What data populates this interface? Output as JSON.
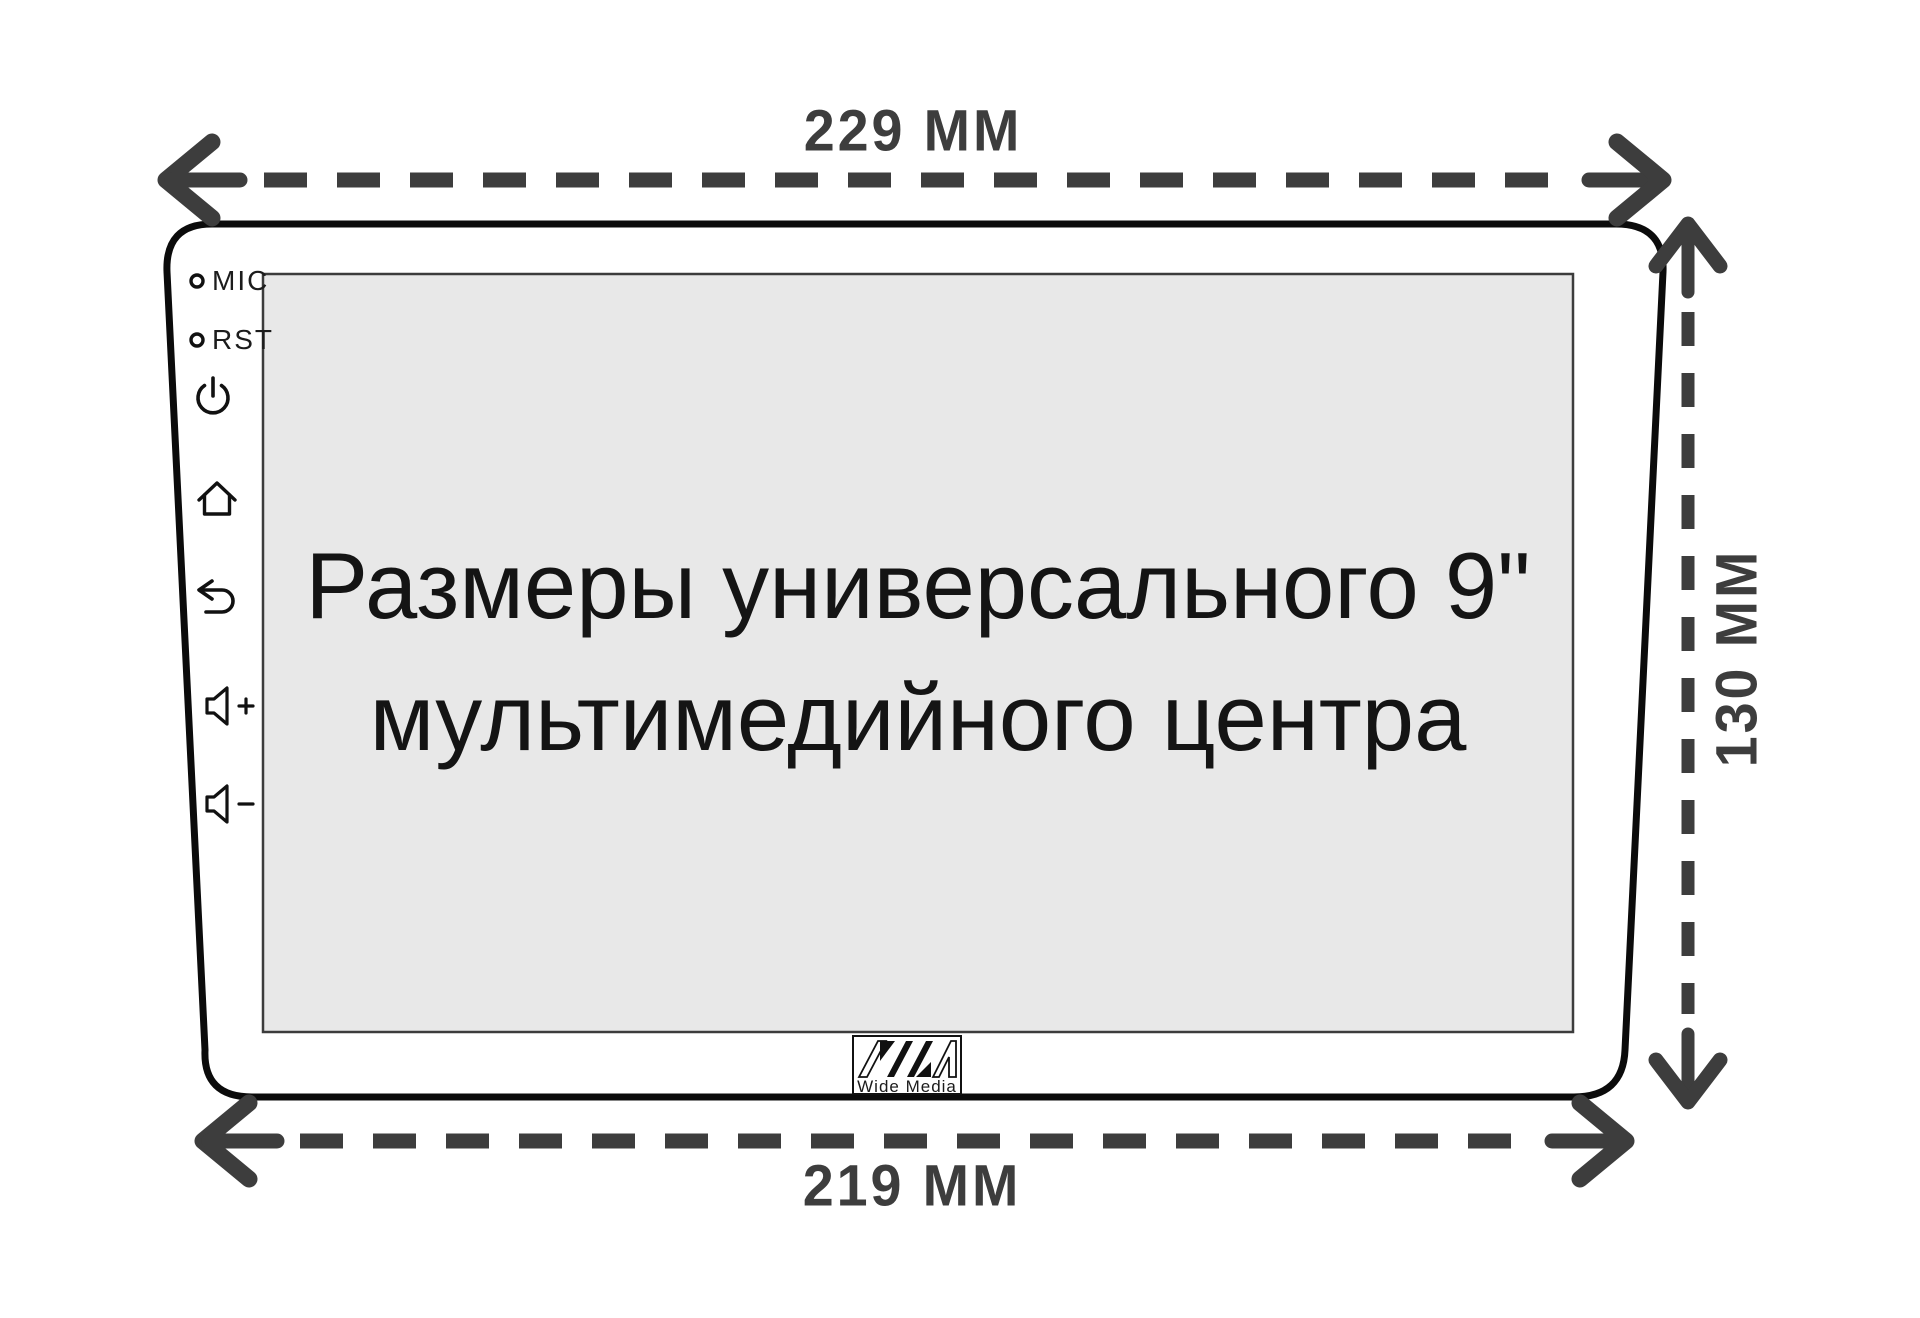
{
  "dimensions": {
    "top": "229 MM",
    "bottom": "219 MM",
    "right": "130 MM"
  },
  "device": {
    "ports": [
      {
        "label": "MIC"
      },
      {
        "label": "RST"
      }
    ],
    "bezel_icons": [
      "mic-hole",
      "rst-hole",
      "power",
      "home",
      "back",
      "volume-up",
      "volume-down"
    ],
    "screen": {
      "line1": "Размеры универсального 9\"",
      "line2": "мультимедийного центра"
    },
    "logo": {
      "text": "Wide Media"
    }
  },
  "colors": {
    "dimension": "#3d3d3d",
    "outline": "#0b0b0b",
    "screen_bg": "#e8e8e8",
    "screen_border": "#3c3c3c"
  }
}
